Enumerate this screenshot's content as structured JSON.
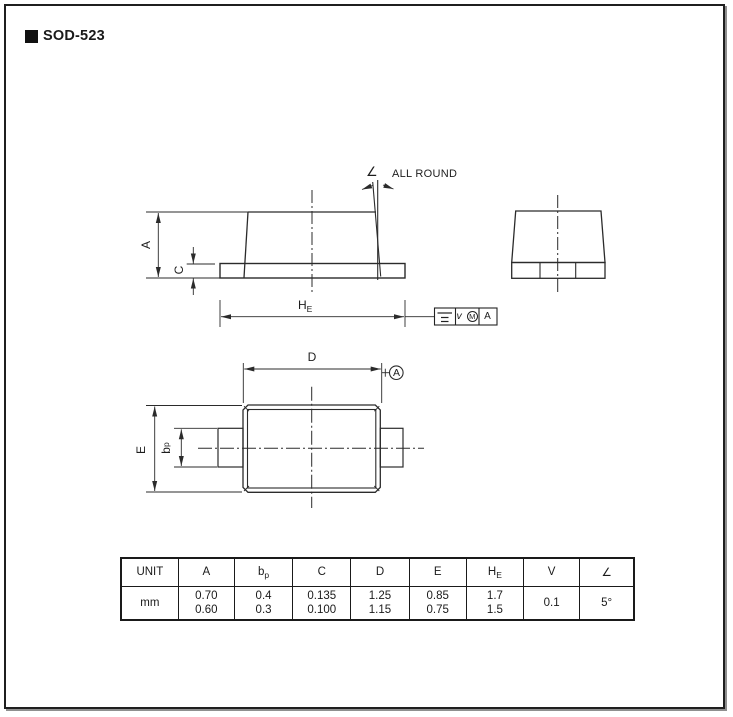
{
  "page": {
    "title": "SOD-523"
  },
  "front_view": {
    "label_a": "A",
    "label_c": "C",
    "label_he": {
      "main": "H",
      "sub": "E"
    },
    "angle_symbol": "∠",
    "all_round": "ALL ROUND",
    "tolerance_frame": {
      "value": "v",
      "modifier": "M",
      "datum": "A"
    }
  },
  "top_view": {
    "label_d": "D",
    "label_e": "E",
    "label_bp": {
      "main": "b",
      "sub": "p"
    },
    "datum": "A"
  },
  "table": {
    "headers": [
      {
        "main": "UNIT",
        "sub": ""
      },
      {
        "main": "A",
        "sub": ""
      },
      {
        "main": "b",
        "sub": "p"
      },
      {
        "main": "C",
        "sub": ""
      },
      {
        "main": "D",
        "sub": ""
      },
      {
        "main": "E",
        "sub": ""
      },
      {
        "main": "H",
        "sub": "E"
      },
      {
        "main": "V",
        "sub": ""
      },
      {
        "main": "∠",
        "sub": ""
      }
    ],
    "rows": [
      {
        "cells": [
          {
            "line1": "mm",
            "line2": ""
          },
          {
            "line1": "0.70",
            "line2": "0.60"
          },
          {
            "line1": "0.4",
            "line2": "0.3"
          },
          {
            "line1": "0.135",
            "line2": "0.100"
          },
          {
            "line1": "1.25",
            "line2": "1.15"
          },
          {
            "line1": "0.85",
            "line2": "0.75"
          },
          {
            "line1": "1.7",
            "line2": "1.5"
          },
          {
            "line1": "0.1",
            "line2": ""
          },
          {
            "line1": "5°",
            "line2": ""
          }
        ]
      }
    ]
  },
  "colors": {
    "line": "#2b2b2b",
    "text": "#1a1a1a"
  }
}
